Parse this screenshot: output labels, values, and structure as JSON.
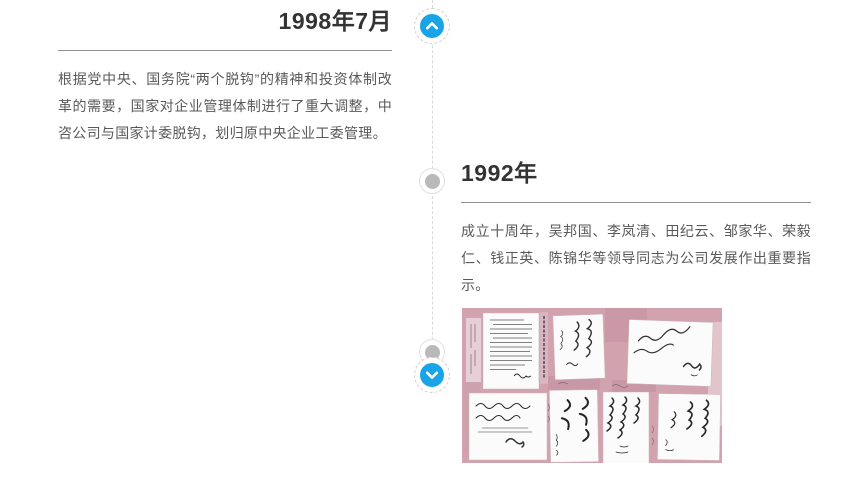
{
  "page": {
    "background_color": "#ffffff",
    "accent_color": "#18a4e6",
    "timeline_line_color": "#d9d9d9",
    "node_dot_color": "#b9b9b9"
  },
  "timeline": {
    "up_label": "向上翻动时间轴",
    "up_icon": "chevron-up",
    "down_label": "向下翻动时间轴",
    "down_icon": "chevron-down"
  },
  "events": [
    {
      "title": "1998年7月",
      "body": "根据党中央、国务院“两个脱钩”的精神和投资体制改革的需要，国家对企业管理体制进行了重大调整，中咨公司与国家计委脱钩，划归原中央企业工委管理。"
    },
    {
      "title": "1992年",
      "body": "成立十周年，吴邦国、李岚清、田纪云、邹家华、荣毅仁、钱正英、陈锦华等领导同志为公司发展作出重要指示。",
      "image_alt": "领导同志题词手迹拼图照片"
    }
  ]
}
